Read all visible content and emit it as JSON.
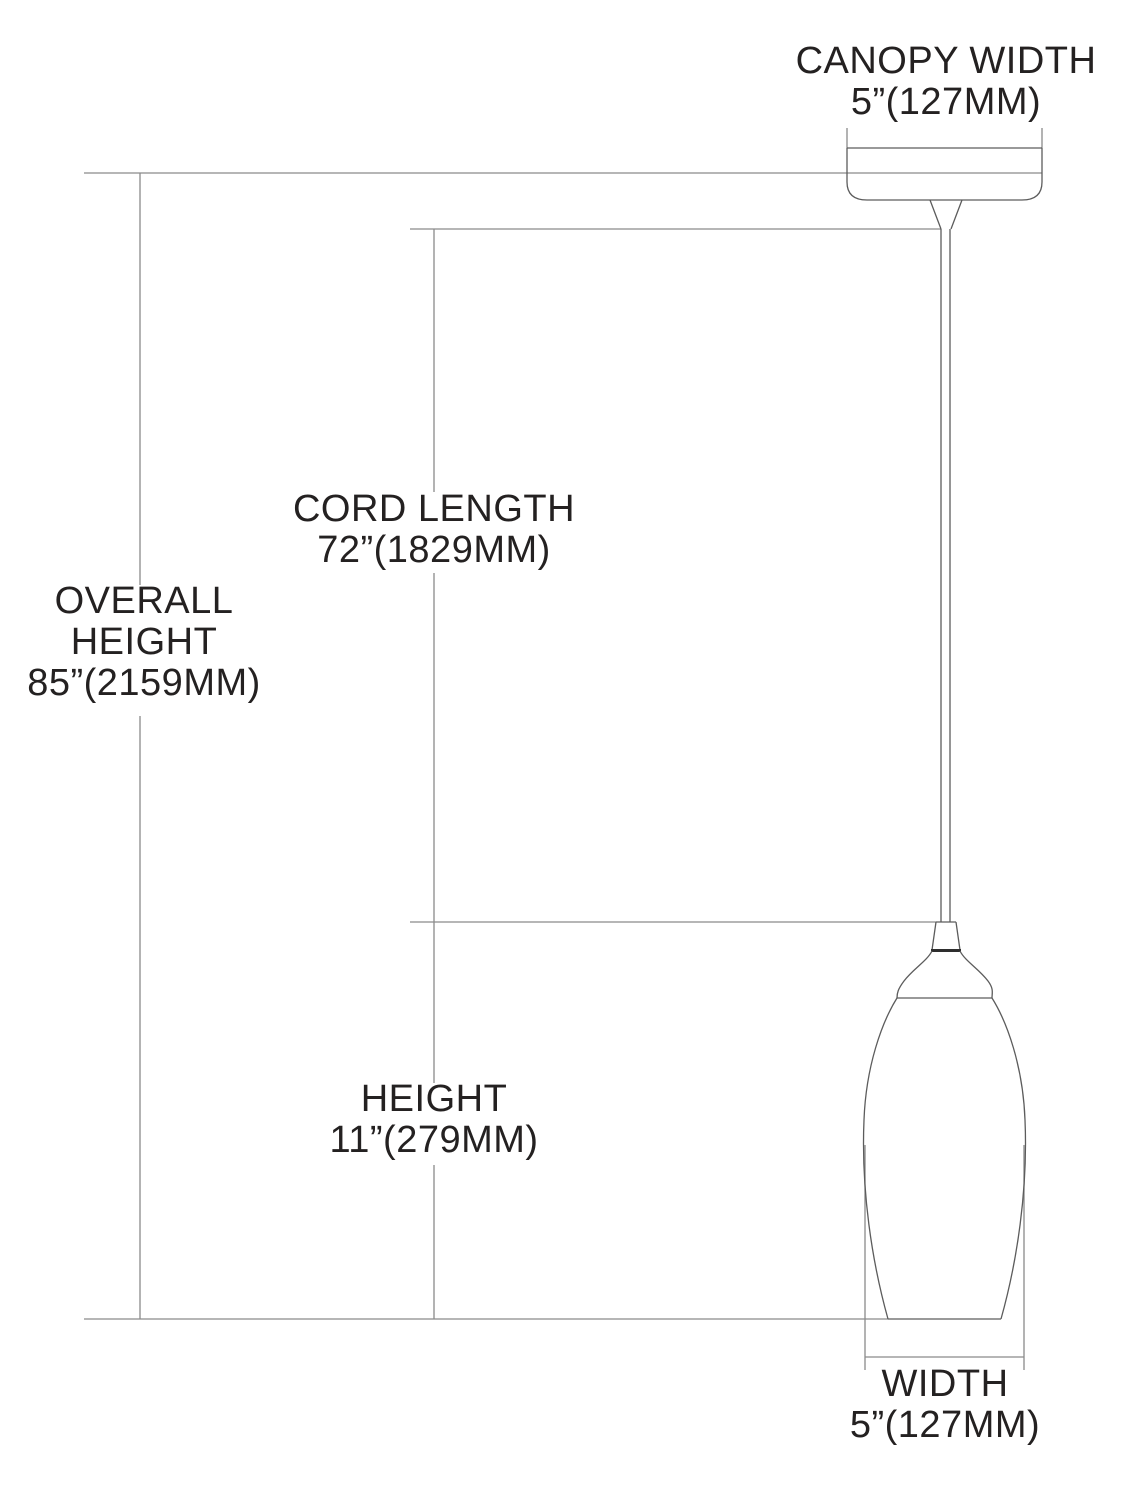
{
  "diagram": {
    "colors": {
      "background": "#ffffff",
      "dimension_line": "#8a8a8a",
      "fixture_outline": "#5c5c5c",
      "text": "#242121"
    },
    "measurements": {
      "canopy_width": {
        "label": "CANOPY WIDTH",
        "value": "5”(127MM)"
      },
      "cord_length": {
        "label": "CORD LENGTH",
        "value": "72”(1829MM)"
      },
      "overall_height": {
        "label": "OVERALL HEIGHT",
        "value": "85”(2159MM)"
      },
      "height": {
        "label": "HEIGHT",
        "value": "11”(279MM)"
      },
      "width": {
        "label": "WIDTH",
        "value": "5”(127MM)"
      }
    }
  }
}
